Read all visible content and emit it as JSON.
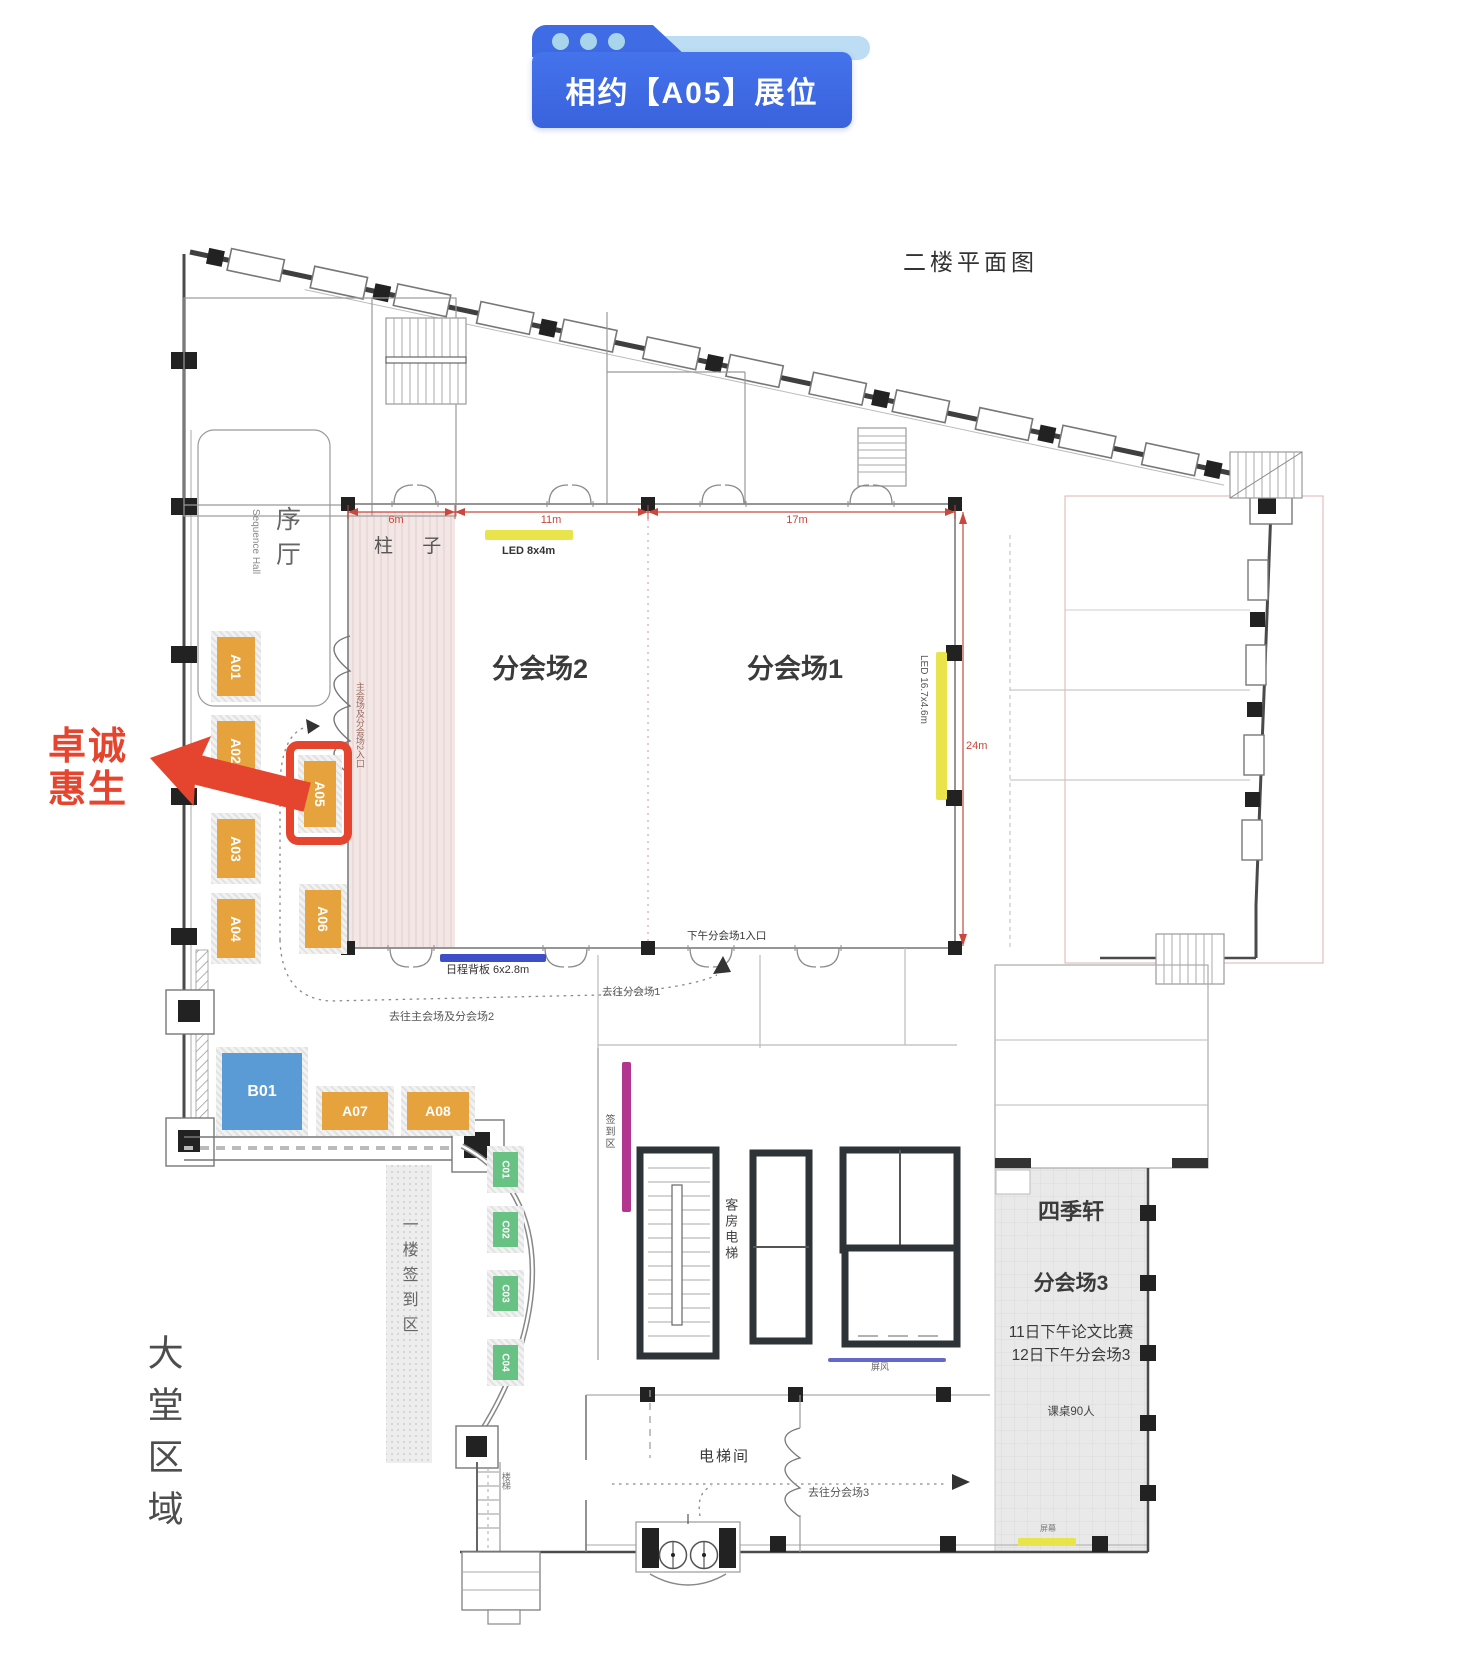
{
  "header": {
    "title": "相约【A05】展位"
  },
  "colors": {
    "accent_red": "#E5452F",
    "booth_orange": "#E6A23C",
    "booth_blue": "#5B9BD5",
    "booth_green": "#67C283",
    "led_yellow": "#E9E44B",
    "board_blue": "#3D4EC6",
    "screen_blue": "#6468C8",
    "signin_purple": "#B2368F",
    "dim_red": "#C9473C",
    "header_blue": "#3F6BE4",
    "header_light_blue": "#BCDDF3"
  },
  "plan": {
    "title": "二楼平面图",
    "company_line1": "卓诚",
    "company_line2": "惠生",
    "highlight_booth": "A05",
    "areas": {
      "xu_hall": "序厅",
      "xu_hall_en": "Sequence Hall",
      "pillar": "柱 子",
      "hall2": "分会场2",
      "hall1": "分会场1",
      "siji_pavilion": "四季轩",
      "hall3": "分会场3",
      "hall3_note1": "11日下午论文比赛",
      "hall3_note2": "12日下午分会场3",
      "hall3_desks": "课桌90人",
      "lobby": "大堂区域",
      "first_floor_signin": "一楼签到区",
      "signin": "签到区",
      "guest_elevator": "客房电梯",
      "elevator_hall": "电梯间",
      "stairs": "楼梯"
    },
    "routes": {
      "main_hall2_entry": "主会场及分会场2入口",
      "hall1_entry": "下午分会场1入口",
      "to_hall1": "去往分会场1",
      "to_main_hall2": "去往主会场及分会场2",
      "to_hall3": "去往分会场3"
    },
    "fixtures": {
      "led_top": "LED 8x4m",
      "led_right": "LED 16.7x4.6m",
      "schedule_board": "日程背板 6x2.8m",
      "screen_wall": "屏风",
      "screen": "屏幕"
    },
    "dimensions": {
      "d6": "6m",
      "d11": "11m",
      "d17": "17m",
      "d24": "24m"
    },
    "booths": [
      {
        "id": "A01",
        "label": "A01"
      },
      {
        "id": "A02",
        "label": "A02"
      },
      {
        "id": "A03",
        "label": "A03"
      },
      {
        "id": "A04",
        "label": "A04"
      },
      {
        "id": "A05",
        "label": "A05"
      },
      {
        "id": "A06",
        "label": "A06"
      },
      {
        "id": "A07",
        "label": "A07"
      },
      {
        "id": "A08",
        "label": "A08"
      },
      {
        "id": "B01",
        "label": "B01"
      },
      {
        "id": "C01",
        "label": "C01"
      },
      {
        "id": "C02",
        "label": "C02"
      },
      {
        "id": "C03",
        "label": "C03"
      },
      {
        "id": "C04",
        "label": "C04"
      }
    ]
  }
}
